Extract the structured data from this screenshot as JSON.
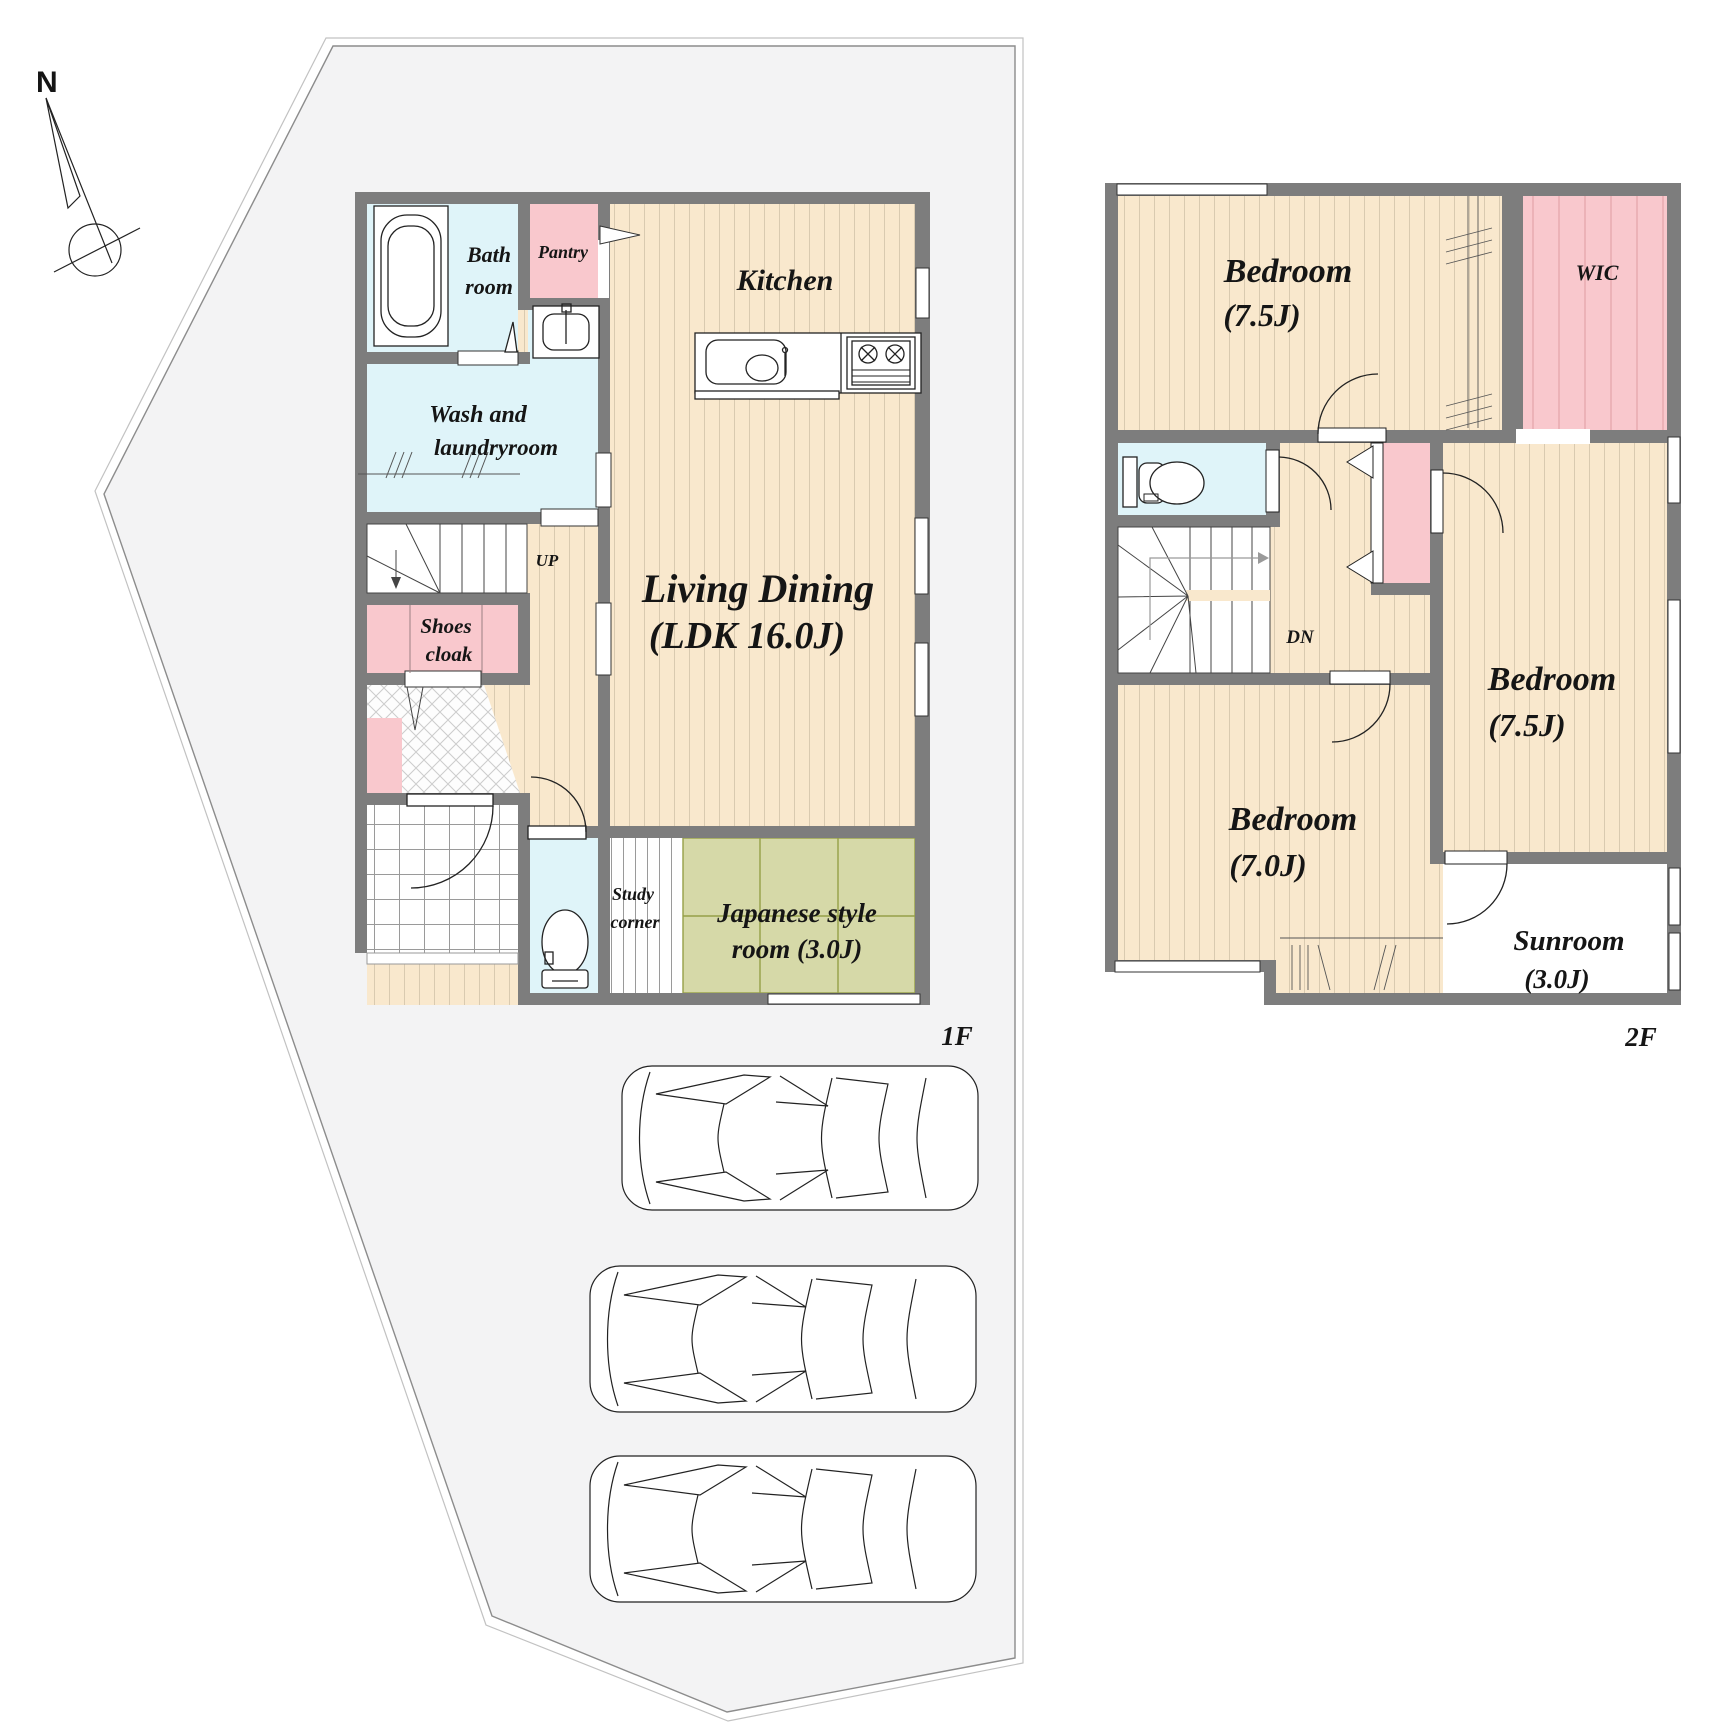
{
  "compass": {
    "north_label": "N"
  },
  "colors": {
    "wall": "#7d7d7d",
    "wood_floor": "#f9e8cd",
    "wet_room_blue": "#dff4f9",
    "closet_pink": "#f9c8cd",
    "tatami_green": "#d6d9a8",
    "lot_fill": "#f3f3f4",
    "line": "#222222"
  },
  "floor1": {
    "floor_label": "1F",
    "rooms": {
      "bath": {
        "line1": "Bath",
        "line2": "room"
      },
      "pantry": {
        "label": "Pantry"
      },
      "kitchen": {
        "label": "Kitchen"
      },
      "wash": {
        "line1": "Wash and",
        "line2": "laundryroom"
      },
      "stairs": {
        "label": "UP"
      },
      "shoes": {
        "line1": "Shoes",
        "line2": "cloak"
      },
      "living": {
        "line1": "Living Dining",
        "line2": "(LDK 16.0J)"
      },
      "study": {
        "line1": "Study",
        "line2": "corner"
      },
      "japanese": {
        "line1": "Japanese style",
        "line2": "room (3.0J)"
      }
    }
  },
  "floor2": {
    "floor_label": "2F",
    "rooms": {
      "bedroom_nw": {
        "line1": "Bedroom",
        "line2": "(7.5J)"
      },
      "wic": {
        "label": "WIC"
      },
      "stairs": {
        "label": "DN"
      },
      "bedroom_e": {
        "line1": "Bedroom",
        "line2": "(7.5J)"
      },
      "bedroom_sw": {
        "line1": "Bedroom",
        "line2": "(7.0J)"
      },
      "sunroom": {
        "line1": "Sunroom",
        "line2": "(3.0J)"
      }
    }
  }
}
